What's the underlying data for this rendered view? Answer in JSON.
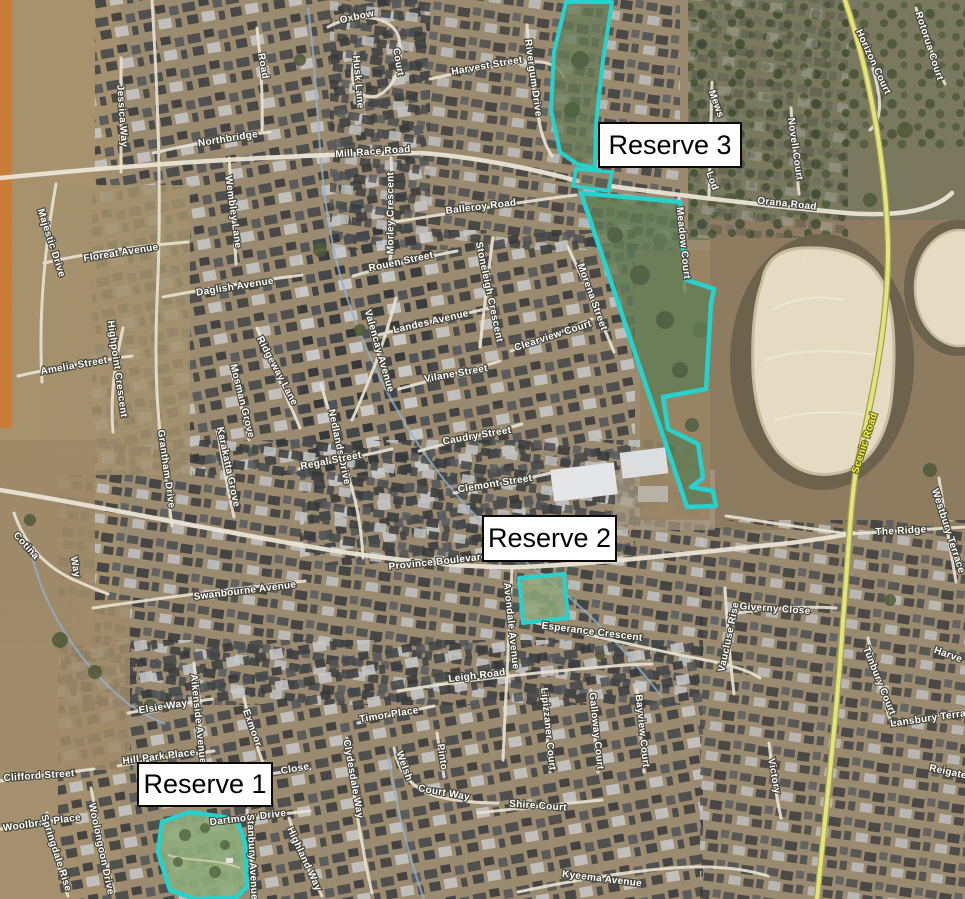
{
  "map": {
    "type": "aerial-satellite-map",
    "reserves": [
      {
        "id": "reserve-1",
        "label": "Reserve 1"
      },
      {
        "id": "reserve-2",
        "label": "Reserve 2"
      },
      {
        "id": "reserve-3",
        "label": "Reserve 3"
      }
    ],
    "colors": {
      "reserve_outline": "#1ed6d2",
      "reserve_fill": "#6c8a5b",
      "road": "#ece6d6",
      "major_road": "#efe9da",
      "scenic_road_line": "#e9e978",
      "scenic_road_label": "#f5f042",
      "creek": "#8fb3cd",
      "street_label_text": "#ffffff",
      "street_label_halo": "#45453a",
      "callout_bg": "#ffffff",
      "callout_border": "#0a0a0a",
      "orange_edge_strip": "#cc7c33",
      "basin_fill": "#e9e0c6"
    },
    "street_labels": [
      {
        "text": "Oxbow",
        "x": 357,
        "y": 17,
        "rot": -12
      },
      {
        "text": "Court",
        "x": 398,
        "y": 62,
        "rot": 80
      },
      {
        "text": "Husk Lane",
        "x": 358,
        "y": 82,
        "rot": 85
      },
      {
        "text": "Harvest Street",
        "x": 487,
        "y": 66,
        "rot": -10
      },
      {
        "text": "Rivergum Drive",
        "x": 533,
        "y": 78,
        "rot": 82
      },
      {
        "text": "Mill Race Road",
        "x": 373,
        "y": 152,
        "rot": -4
      },
      {
        "text": "Northbridge",
        "x": 228,
        "y": 139,
        "rot": -9
      },
      {
        "text": "Road",
        "x": 263,
        "y": 66,
        "rot": 80
      },
      {
        "text": "Jessica Way",
        "x": 122,
        "y": 116,
        "rot": 86
      },
      {
        "text": "Wembley Lane",
        "x": 233,
        "y": 212,
        "rot": 82
      },
      {
        "text": "Balleroy Road",
        "x": 481,
        "y": 207,
        "rot": -7
      },
      {
        "text": "Morley Crescent",
        "x": 391,
        "y": 213,
        "rot": -90
      },
      {
        "text": "Rouen Street",
        "x": 401,
        "y": 262,
        "rot": -12
      },
      {
        "text": "Stoneleigh Crescent",
        "x": 489,
        "y": 292,
        "rot": 78
      },
      {
        "text": "Landes Avenue",
        "x": 431,
        "y": 322,
        "rot": -13
      },
      {
        "text": "Valencay Avenue",
        "x": 379,
        "y": 351,
        "rot": 74
      },
      {
        "text": "Vilane Street",
        "x": 456,
        "y": 374,
        "rot": -10
      },
      {
        "text": "Clearview Court",
        "x": 553,
        "y": 336,
        "rot": -18
      },
      {
        "text": "Morena Street",
        "x": 592,
        "y": 297,
        "rot": 70
      },
      {
        "text": "Nedlands Drive",
        "x": 339,
        "y": 447,
        "rot": 78
      },
      {
        "text": "Caudry Street",
        "x": 477,
        "y": 436,
        "rot": -10
      },
      {
        "text": "Regal Street",
        "x": 331,
        "y": 461,
        "rot": -11
      },
      {
        "text": "Clemont Street",
        "x": 495,
        "y": 484,
        "rot": -9
      },
      {
        "text": "Floreat Avenue",
        "x": 121,
        "y": 253,
        "rot": -9
      },
      {
        "text": "Daglish Avenue",
        "x": 235,
        "y": 287,
        "rot": -9
      },
      {
        "text": "Amelia Street",
        "x": 74,
        "y": 366,
        "rot": -10
      },
      {
        "text": "Highpoint Crescent",
        "x": 117,
        "y": 369,
        "rot": 82
      },
      {
        "text": "Ridgeway Lane",
        "x": 277,
        "y": 371,
        "rot": 62
      },
      {
        "text": "Mosman Grove",
        "x": 242,
        "y": 401,
        "rot": 76
      },
      {
        "text": "Majestic Drive",
        "x": 51,
        "y": 243,
        "rot": 72
      },
      {
        "text": "Cotina",
        "x": 26,
        "y": 546,
        "rot": 48
      },
      {
        "text": "Way",
        "x": 75,
        "y": 567,
        "rot": 80
      },
      {
        "text": "Grantham Drive",
        "x": 166,
        "y": 469,
        "rot": 82
      },
      {
        "text": "Karakatta Grove",
        "x": 228,
        "y": 467,
        "rot": 78
      },
      {
        "text": "Swanbourne Avenue",
        "x": 245,
        "y": 591,
        "rot": -7
      },
      {
        "text": "Province Boulevard",
        "x": 438,
        "y": 562,
        "rot": -6
      },
      {
        "text": "Avondale Avenue",
        "x": 511,
        "y": 626,
        "rot": 84
      },
      {
        "text": "Esperance Crescent",
        "x": 592,
        "y": 632,
        "rot": 7
      },
      {
        "text": "Giverny Close",
        "x": 775,
        "y": 609,
        "rot": 4
      },
      {
        "text": "Vaucluse Rise",
        "x": 729,
        "y": 637,
        "rot": -78
      },
      {
        "text": "Leigh Road",
        "x": 477,
        "y": 676,
        "rot": -7
      },
      {
        "text": "Elsie Way",
        "x": 163,
        "y": 707,
        "rot": -9
      },
      {
        "text": "Hill Park Place",
        "x": 159,
        "y": 757,
        "rot": -7
      },
      {
        "text": "Clifford Street",
        "x": 39,
        "y": 776,
        "rot": -4
      },
      {
        "text": "Woolbrae Place",
        "x": 42,
        "y": 823,
        "rot": -8
      },
      {
        "text": "Springdale Rise",
        "x": 56,
        "y": 853,
        "rot": 72
      },
      {
        "text": "Woolongoon Drive",
        "x": 101,
        "y": 849,
        "rot": 78
      },
      {
        "text": "Aikenside Avenue",
        "x": 198,
        "y": 719,
        "rot": 84
      },
      {
        "text": "Exmoor",
        "x": 252,
        "y": 728,
        "rot": 70
      },
      {
        "text": "Close",
        "x": 295,
        "y": 769,
        "rot": -10
      },
      {
        "text": "Timor Place",
        "x": 389,
        "y": 715,
        "rot": -9
      },
      {
        "text": "Clydesdale Way",
        "x": 353,
        "y": 779,
        "rot": 80
      },
      {
        "text": "Dartmoor Drive",
        "x": 248,
        "y": 818,
        "rot": -7
      },
      {
        "text": "Stanbury Avenue",
        "x": 252,
        "y": 857,
        "rot": 87
      },
      {
        "text": "Highland Way",
        "x": 304,
        "y": 859,
        "rot": 65
      },
      {
        "text": "Pinto",
        "x": 442,
        "y": 757,
        "rot": 82
      },
      {
        "text": "Welsh",
        "x": 404,
        "y": 766,
        "rot": 70
      },
      {
        "text": "Court Way",
        "x": 444,
        "y": 793,
        "rot": 10
      },
      {
        "text": "Shire Court",
        "x": 538,
        "y": 806,
        "rot": 4
      },
      {
        "text": "Kyeema Avenue",
        "x": 602,
        "y": 879,
        "rot": 7
      },
      {
        "text": "Lipizzaner Court",
        "x": 548,
        "y": 729,
        "rot": 84
      },
      {
        "text": "Galloway Court",
        "x": 596,
        "y": 731,
        "rot": 84
      },
      {
        "text": "Bayview Court",
        "x": 642,
        "y": 731,
        "rot": 84
      },
      {
        "text": "Orana Road",
        "x": 787,
        "y": 204,
        "rot": 6
      },
      {
        "text": "Meadow Court",
        "x": 683,
        "y": 243,
        "rot": 84
      },
      {
        "text": "Mews",
        "x": 716,
        "y": 104,
        "rot": 70
      },
      {
        "text": "Lod",
        "x": 712,
        "y": 181,
        "rot": 70
      },
      {
        "text": "Novell Court",
        "x": 795,
        "y": 149,
        "rot": 82
      },
      {
        "text": "Horizon Court",
        "x": 873,
        "y": 62,
        "rot": 65
      },
      {
        "text": "Rotorua Court",
        "x": 929,
        "y": 46,
        "rot": 72
      },
      {
        "text": "Scenic Road",
        "x": 865,
        "y": 443,
        "rot": -72,
        "size": 13,
        "cls": "yellow"
      },
      {
        "text": "The Ridge",
        "x": 901,
        "y": 531,
        "rot": -3
      },
      {
        "text": "Westbury Terrace",
        "x": 948,
        "y": 531,
        "rot": 72
      },
      {
        "text": "Tunbury Court",
        "x": 879,
        "y": 681,
        "rot": 68
      },
      {
        "text": "Lansbury Terrace",
        "x": 934,
        "y": 718,
        "rot": -8
      },
      {
        "text": "Reigate",
        "x": 948,
        "y": 772,
        "rot": 12
      },
      {
        "text": "Harve",
        "x": 948,
        "y": 655,
        "rot": 20
      },
      {
        "text": "Victory",
        "x": 774,
        "y": 776,
        "rot": 80
      }
    ]
  }
}
